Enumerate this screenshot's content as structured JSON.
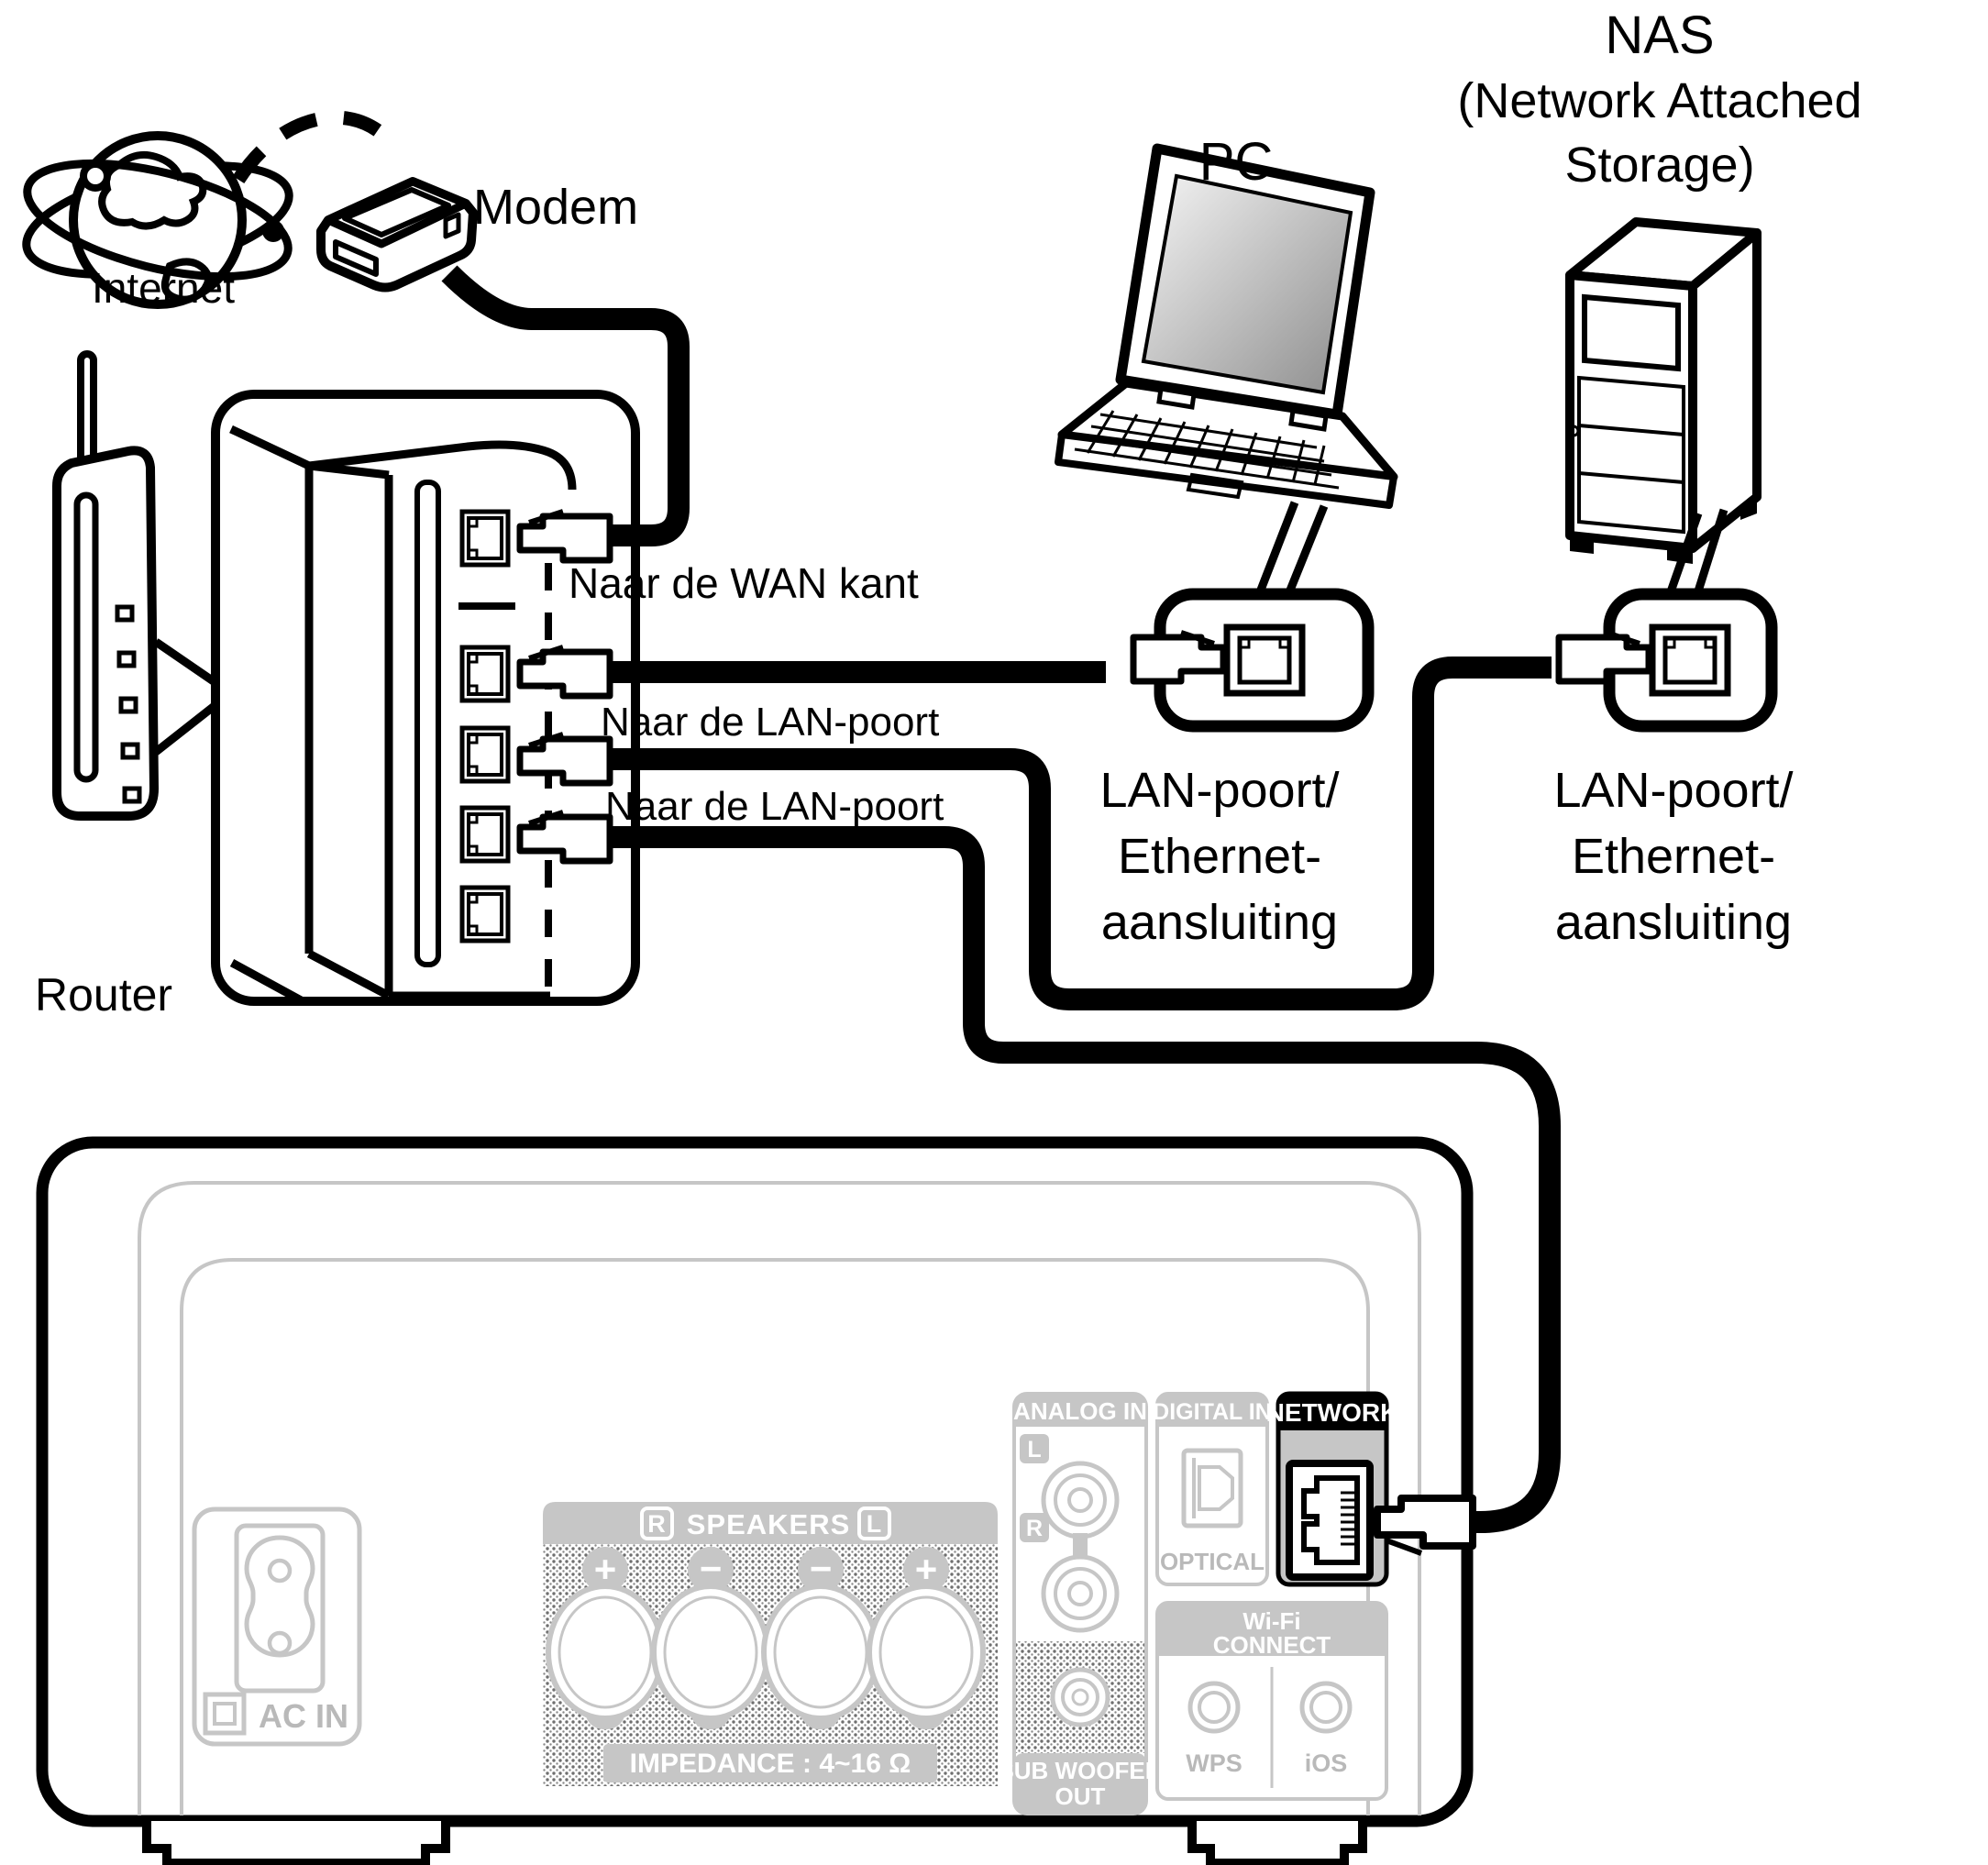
{
  "title": "Netwerk aansluitschema",
  "colors": {
    "line": "#000000",
    "panel_gray": "#c6c6c6",
    "panel_text_gray": "#b9b9b9",
    "network_header_bg": "#000000",
    "network_header_text": "#ffffff"
  },
  "labels": {
    "internet": "Internet",
    "modem": "Modem",
    "router": "Router",
    "pc": "PC",
    "nas1": "NAS",
    "nas2": "(Network Attached",
    "nas3": "Storage)",
    "wan": "Naar de WAN kant",
    "lan1": "Naar de LAN-poort",
    "lan2": "Naar de LAN-poort",
    "pc_port1": "LAN-poort/",
    "pc_port2": "Ethernet-",
    "pc_port3": "aansluiting",
    "nas_port1": "LAN-poort/",
    "nas_port2": "Ethernet-",
    "nas_port3": "aansluiting"
  },
  "rear_panel": {
    "ac_in": "AC IN",
    "speakers": {
      "header": "SPEAKERS",
      "right": "R",
      "left": "L",
      "impedance": "IMPEDANCE : 4~16 Ω",
      "terminals": [
        "+",
        "−",
        "−",
        "+"
      ]
    },
    "analog_in": {
      "header": "ANALOG IN",
      "l": "L",
      "r": "R"
    },
    "digital_in": {
      "header": "DIGITAL IN",
      "optical": "OPTICAL"
    },
    "network": {
      "header": "NETWORK"
    },
    "wifi": {
      "header1": "Wi-Fi",
      "header2": "CONNECT",
      "wps": "WPS",
      "ios": "iOS"
    },
    "subwoofer": {
      "line1": "SUB WOOFER",
      "line2": "OUT"
    }
  }
}
